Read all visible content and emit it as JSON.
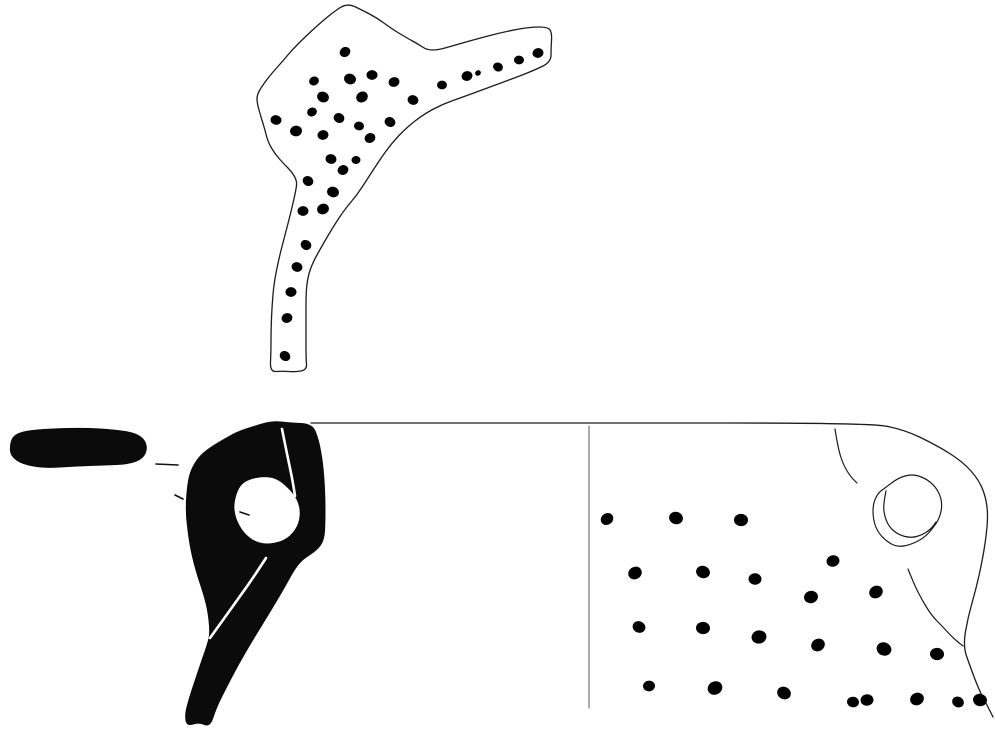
{
  "canvas": {
    "width": 995,
    "height": 730,
    "background": "#ffffff"
  },
  "palette": {
    "ink": "#0b0b0b",
    "outline": "#1c1c1c",
    "paper": "#ffffff",
    "divider": "#5a5a5a"
  },
  "figure": {
    "shapes": [
      {
        "name": "handle-fragment-outline",
        "type": "smooth-closed",
        "fill": "#ffffff",
        "stroke": "#1c1c1c",
        "strokeWidth": 1.3,
        "points": [
          [
            347,
            3
          ],
          [
            362,
            10
          ],
          [
            377,
            18
          ],
          [
            392,
            29
          ],
          [
            407,
            38
          ],
          [
            418,
            44
          ],
          [
            427,
            50
          ],
          [
            438,
            50
          ],
          [
            452,
            46
          ],
          [
            473,
            40
          ],
          [
            503,
            32
          ],
          [
            530,
            27
          ],
          [
            548,
            27
          ],
          [
            552,
            33
          ],
          [
            551,
            48
          ],
          [
            551,
            62
          ],
          [
            535,
            70
          ],
          [
            517,
            77
          ],
          [
            490,
            87
          ],
          [
            463,
            97
          ],
          [
            443,
            104
          ],
          [
            424,
            114
          ],
          [
            406,
            128
          ],
          [
            391,
            144
          ],
          [
            379,
            161
          ],
          [
            368,
            178
          ],
          [
            357,
            195
          ],
          [
            345,
            209
          ],
          [
            333,
            227
          ],
          [
            322,
            246
          ],
          [
            313,
            262
          ],
          [
            308,
            276
          ],
          [
            306,
            292
          ],
          [
            306,
            315
          ],
          [
            306,
            338
          ],
          [
            306,
            358
          ],
          [
            307,
            370
          ],
          [
            295,
            372
          ],
          [
            282,
            371
          ],
          [
            270,
            372
          ],
          [
            271,
            352
          ],
          [
            271,
            330
          ],
          [
            272,
            306
          ],
          [
            274,
            283
          ],
          [
            279,
            258
          ],
          [
            285,
            235
          ],
          [
            291,
            212
          ],
          [
            296,
            190
          ],
          [
            297,
            181
          ],
          [
            292,
            172
          ],
          [
            284,
            164
          ],
          [
            275,
            154
          ],
          [
            268,
            142
          ],
          [
            265,
            130
          ],
          [
            261,
            117
          ],
          [
            257,
            103
          ],
          [
            257,
            95
          ],
          [
            262,
            86
          ],
          [
            272,
            73
          ],
          [
            282,
            62
          ],
          [
            292,
            50
          ],
          [
            305,
            37
          ],
          [
            318,
            25
          ],
          [
            332,
            13
          ]
        ]
      },
      {
        "name": "handle-plan-section",
        "type": "smooth-closed",
        "fill": "#0b0b0b",
        "stroke": "#0b0b0b",
        "strokeWidth": 1,
        "points": [
          [
            10,
            446
          ],
          [
            13,
            436
          ],
          [
            25,
            431
          ],
          [
            50,
            429
          ],
          [
            85,
            428
          ],
          [
            115,
            430
          ],
          [
            135,
            433
          ],
          [
            145,
            440
          ],
          [
            147,
            450
          ],
          [
            142,
            459
          ],
          [
            128,
            464
          ],
          [
            105,
            465
          ],
          [
            75,
            466
          ],
          [
            45,
            468
          ],
          [
            22,
            464
          ],
          [
            11,
            456
          ]
        ]
      },
      {
        "name": "leader-dash-a",
        "type": "line",
        "stroke": "#111111",
        "strokeWidth": 1.6,
        "points": [
          [
            156,
            464
          ],
          [
            178,
            465
          ]
        ]
      },
      {
        "name": "leader-dash-b",
        "type": "line",
        "stroke": "#111111",
        "strokeWidth": 1.6,
        "points": [
          [
            175,
            495
          ],
          [
            183,
            499
          ]
        ]
      },
      {
        "name": "leader-dash-c",
        "type": "line",
        "stroke": "#111111",
        "strokeWidth": 1.6,
        "points": [
          [
            240,
            512
          ],
          [
            249,
            515
          ]
        ]
      },
      {
        "name": "profile-section-solid",
        "type": "smooth-closed",
        "fill": "#0b0b0b",
        "stroke": "#0b0b0b",
        "strokeWidth": 1,
        "points": [
          [
            273,
            421
          ],
          [
            290,
            423
          ],
          [
            312,
            424
          ],
          [
            318,
            438
          ],
          [
            322,
            458
          ],
          [
            324,
            478
          ],
          [
            325,
            500
          ],
          [
            325,
            522
          ],
          [
            324,
            540
          ],
          [
            317,
            550
          ],
          [
            303,
            559
          ],
          [
            295,
            568
          ],
          [
            283,
            590
          ],
          [
            268,
            615
          ],
          [
            252,
            641
          ],
          [
            238,
            665
          ],
          [
            226,
            688
          ],
          [
            216,
            708
          ],
          [
            210,
            727
          ],
          [
            199,
            722
          ],
          [
            187,
            726
          ],
          [
            185,
            715
          ],
          [
            189,
            699
          ],
          [
            195,
            681
          ],
          [
            202,
            660
          ],
          [
            209,
            640
          ],
          [
            210,
            630
          ],
          [
            208,
            611
          ],
          [
            204,
            595
          ],
          [
            198,
            577
          ],
          [
            194,
            563
          ],
          [
            191,
            550
          ],
          [
            188,
            532
          ],
          [
            186,
            511
          ],
          [
            187,
            490
          ],
          [
            190,
            472
          ],
          [
            198,
            458
          ],
          [
            208,
            449
          ],
          [
            221,
            441
          ],
          [
            237,
            432
          ],
          [
            255,
            426
          ]
        ],
        "hole": [
          [
            249,
            479
          ],
          [
            263,
            476
          ],
          [
            277,
            478
          ],
          [
            290,
            489
          ],
          [
            298,
            500
          ],
          [
            301,
            513
          ],
          [
            298,
            527
          ],
          [
            288,
            539
          ],
          [
            274,
            544
          ],
          [
            259,
            544
          ],
          [
            246,
            536
          ],
          [
            237,
            523
          ],
          [
            233,
            508
          ],
          [
            236,
            493
          ],
          [
            241,
            484
          ]
        ]
      },
      {
        "name": "section-break-line-upper",
        "type": "smooth-open",
        "stroke": "#ffffff",
        "strokeWidth": 2.6,
        "points": [
          [
            282,
            429
          ],
          [
            286,
            449
          ],
          [
            290,
            468
          ],
          [
            293,
            483
          ],
          [
            295,
            496
          ]
        ]
      },
      {
        "name": "section-break-line-lower",
        "type": "smooth-open",
        "stroke": "#ffffff",
        "strokeWidth": 2.6,
        "points": [
          [
            266,
            558
          ],
          [
            253,
            578
          ],
          [
            238,
            599
          ],
          [
            223,
            620
          ],
          [
            210,
            638
          ]
        ]
      },
      {
        "name": "rim-and-right-edge",
        "type": "smooth-open",
        "stroke": "#1c1c1c",
        "strokeWidth": 1.3,
        "points": [
          [
            311,
            423
          ],
          [
            590,
            423
          ],
          [
            867,
            423
          ],
          [
            903,
            429
          ],
          [
            938,
            446
          ],
          [
            963,
            462
          ],
          [
            979,
            480
          ],
          [
            986,
            498
          ],
          [
            988,
            516
          ],
          [
            986,
            538
          ],
          [
            982,
            562
          ],
          [
            976,
            589
          ],
          [
            968,
            617
          ],
          [
            963,
            646
          ],
          [
            970,
            666
          ],
          [
            979,
            690
          ],
          [
            987,
            705
          ],
          [
            993,
            717
          ]
        ]
      },
      {
        "name": "shoulder-curve",
        "type": "smooth-open",
        "stroke": "#1c1c1c",
        "strokeWidth": 1.2,
        "points": [
          [
            835,
            429
          ],
          [
            838,
            448
          ],
          [
            843,
            464
          ],
          [
            850,
            476
          ],
          [
            857,
            483
          ]
        ]
      },
      {
        "name": "handle-lower-attachment-curve",
        "type": "smooth-open",
        "stroke": "#1c1c1c",
        "strokeWidth": 1.2,
        "points": [
          [
            908,
            569
          ],
          [
            914,
            584
          ],
          [
            922,
            600
          ],
          [
            932,
            616
          ],
          [
            943,
            627
          ],
          [
            953,
            638
          ],
          [
            963,
            646
          ]
        ]
      },
      {
        "name": "handle-attachment-outer",
        "type": "smooth-closed",
        "fill": "none",
        "stroke": "#1c1c1c",
        "strokeWidth": 1.2,
        "points": [
          [
            885,
            488
          ],
          [
            898,
            478
          ],
          [
            912,
            474
          ],
          [
            925,
            478
          ],
          [
            935,
            486
          ],
          [
            941,
            497
          ],
          [
            942,
            508
          ],
          [
            939,
            519
          ],
          [
            933,
            528
          ],
          [
            924,
            538
          ],
          [
            910,
            545
          ],
          [
            897,
            547
          ],
          [
            886,
            541
          ],
          [
            877,
            531
          ],
          [
            873,
            518
          ],
          [
            873,
            504
          ],
          [
            878,
            493
          ]
        ]
      },
      {
        "name": "handle-attachment-inner",
        "type": "smooth-open",
        "stroke": "#1c1c1c",
        "strokeWidth": 1.2,
        "points": [
          [
            886,
            491
          ],
          [
            883,
            505
          ],
          [
            885,
            518
          ],
          [
            890,
            528
          ],
          [
            899,
            535
          ],
          [
            911,
            538
          ],
          [
            922,
            535
          ],
          [
            931,
            529
          ],
          [
            936,
            522
          ]
        ]
      },
      {
        "name": "view-divider-line",
        "type": "line",
        "stroke": "#5a5a5a",
        "strokeWidth": 1,
        "points": [
          [
            589,
            426
          ],
          [
            589,
            708
          ]
        ]
      }
    ],
    "dot_groups": [
      {
        "name": "handle-fragment-dots",
        "fill": "#000000",
        "dots": [
          [
            345,
            52,
            5.5
          ],
          [
            350,
            79,
            6
          ],
          [
            372,
            75,
            5.5
          ],
          [
            394,
            82,
            5.5
          ],
          [
            362,
            97,
            6
          ],
          [
            413,
            100,
            5.5
          ],
          [
            442,
            85,
            5
          ],
          [
            467,
            76,
            5.5
          ],
          [
            478,
            73,
            3
          ],
          [
            498,
            67,
            5
          ],
          [
            519,
            60,
            5
          ],
          [
            538,
            53,
            5.5
          ],
          [
            314,
            81,
            5
          ],
          [
            323,
            97,
            6
          ],
          [
            276,
            120,
            5.5
          ],
          [
            296,
            131,
            6
          ],
          [
            312,
            112,
            5
          ],
          [
            339,
            118,
            5.5
          ],
          [
            359,
            126,
            5
          ],
          [
            323,
            135,
            5.5
          ],
          [
            370,
            138,
            5.5
          ],
          [
            390,
            122,
            5.5
          ],
          [
            331,
            159,
            5.5
          ],
          [
            356,
            160,
            4.5
          ],
          [
            343,
            170,
            5.5
          ],
          [
            308,
            181,
            5.5
          ],
          [
            333,
            192,
            6
          ],
          [
            303,
            211,
            5.5
          ],
          [
            323,
            209,
            6
          ],
          [
            306,
            245,
            5.5
          ],
          [
            297,
            267,
            5.5
          ],
          [
            291,
            292,
            5.5
          ],
          [
            287,
            318,
            5.5
          ],
          [
            285,
            356,
            5.5
          ]
        ]
      },
      {
        "name": "body-exterior-dots",
        "fill": "#000000",
        "dots": [
          [
            607,
            519,
            6.5
          ],
          [
            676,
            518,
            7
          ],
          [
            741,
            520,
            7
          ],
          [
            833,
            561,
            6.5
          ],
          [
            635,
            573,
            7
          ],
          [
            703,
            572,
            7
          ],
          [
            755,
            579,
            6.5
          ],
          [
            811,
            597,
            7
          ],
          [
            876,
            592,
            7
          ],
          [
            639,
            627,
            6.5
          ],
          [
            703,
            628,
            7
          ],
          [
            759,
            637,
            7.5
          ],
          [
            818,
            645,
            7
          ],
          [
            884,
            649,
            7.5
          ],
          [
            937,
            654,
            7
          ],
          [
            649,
            686,
            6
          ],
          [
            715,
            688,
            7.5
          ],
          [
            784,
            693,
            7
          ],
          [
            853,
            702,
            6
          ],
          [
            867,
            700,
            6.5
          ],
          [
            917,
            699,
            7
          ],
          [
            958,
            702,
            6
          ],
          [
            980,
            700,
            7
          ]
        ]
      }
    ]
  }
}
